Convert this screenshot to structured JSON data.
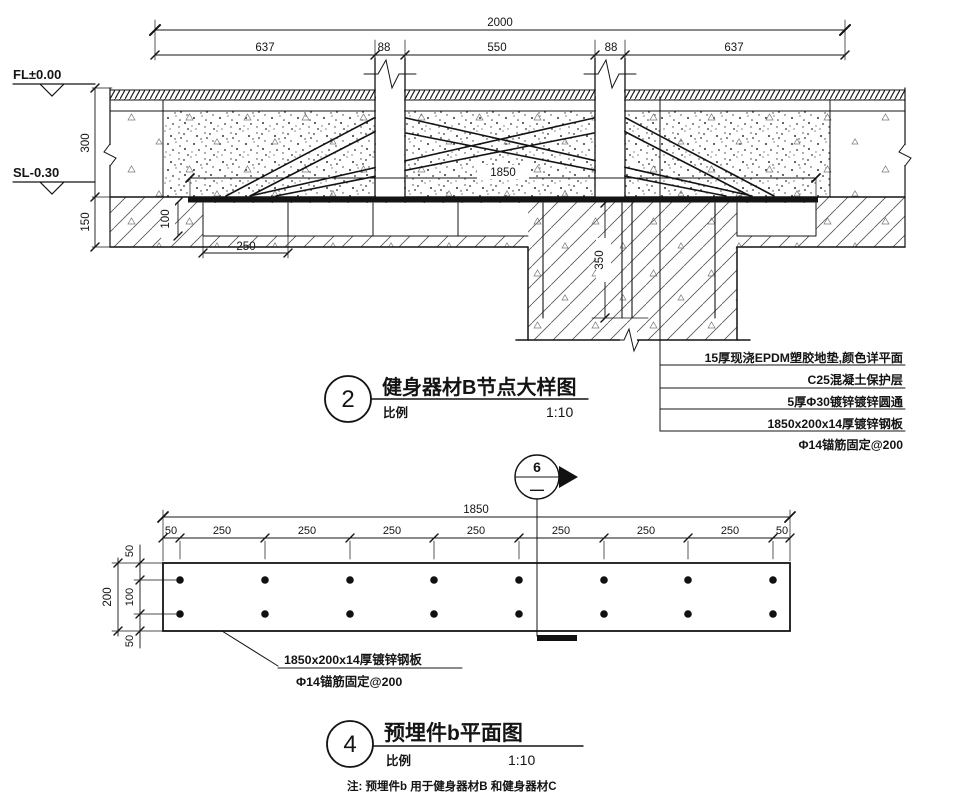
{
  "section": {
    "dims": {
      "total": "2000",
      "segs": [
        "637",
        "88",
        "550",
        "88",
        "637"
      ],
      "plate": "1850",
      "d300": "300",
      "d150": "150",
      "d100": "100",
      "d250": "250",
      "d350": "350"
    },
    "levels": {
      "fl": "FL±0.00",
      "sl": "SL-0.30"
    },
    "notes": [
      "15厚现浇EPDM塑胶地垫,颜色详平面",
      "C25混凝土保护层",
      "5厚Φ30镀锌镀锌圆通",
      "1850x200x14厚镀锌钢板",
      "Φ14锚筋固定@200"
    ],
    "title": {
      "number": "2",
      "text": "健身器材B节点大样图",
      "scale_label": "比例",
      "scale_value": "1:10"
    }
  },
  "plan": {
    "marker": {
      "number": "6",
      "sheet": "—"
    },
    "dims": {
      "total": "1850",
      "segs": [
        "50",
        "250",
        "250",
        "250",
        "250",
        "250",
        "250",
        "250",
        "50"
      ],
      "height": "200",
      "hsegs": [
        "50",
        "100",
        "50"
      ]
    },
    "callouts": [
      "1850x200x14厚镀锌钢板",
      "Φ14锚筋固定@200"
    ],
    "title": {
      "number": "4",
      "text": "预埋件b平面图",
      "scale_label": "比例",
      "scale_value": "1:10"
    },
    "note": "注: 预埋件b 用于健身器材B 和健身器材C"
  }
}
